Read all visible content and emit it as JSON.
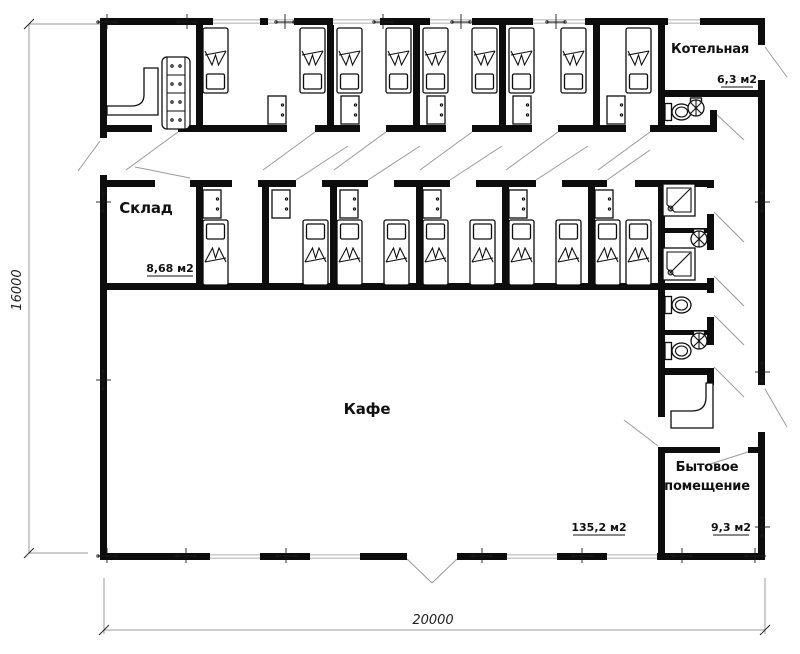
{
  "floor_plan": {
    "rooms": {
      "boiler": {
        "name": "Котельная",
        "area": "6,3 м2"
      },
      "storage": {
        "name": "Склад",
        "area": "8,68 м2"
      },
      "cafe": {
        "name": "Кафе",
        "area": "135,2 м2"
      },
      "utility": {
        "name": "Бытовое помещение",
        "name_line1": "Бытовое",
        "name_line2": "помещение",
        "area": "9,3 м2"
      }
    },
    "dimensions": {
      "overall_height": "16000",
      "overall_width": "20000"
    },
    "colors": {
      "wall": "#0d0d0d",
      "thin_line": "#9a9a9a",
      "window_line": "#b8b8b8",
      "text": "#111111",
      "background": "#ffffff"
    }
  }
}
